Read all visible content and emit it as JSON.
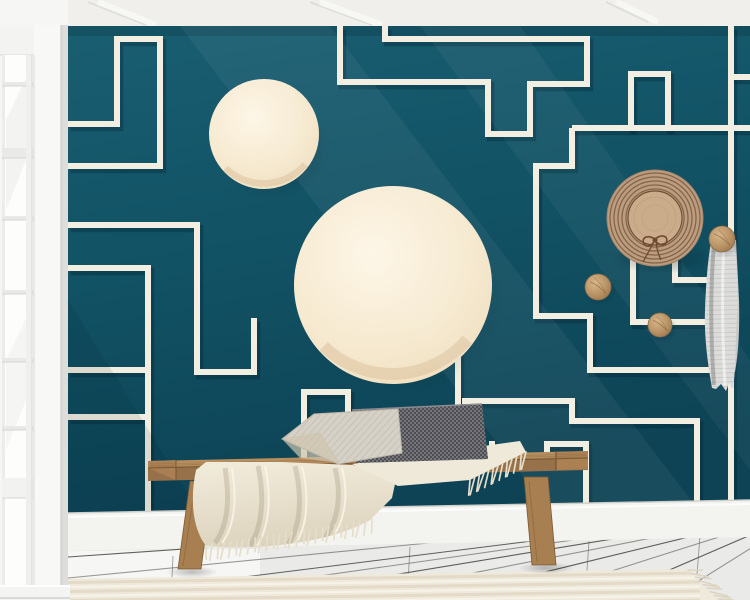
{
  "scene": {
    "name": "teal-geometric-maze-wallpaper-room-mockup",
    "width": 750,
    "height": 600
  },
  "palette": {
    "wall_teal_top": "#1a5e72",
    "wall_teal": "#115264",
    "wall_teal_bottom": "#0d4355",
    "line_cream": "#f2eee1",
    "line_shadow": "rgba(0,30,42,0.30)",
    "circle_cream_light": "#fdf6e7",
    "circle_cream_dark": "#eedcba",
    "ceiling_white": "#f0efec",
    "baseboard_white": "#f3f3f0",
    "floor_white": "#eaeae8",
    "floor_seam": "#3a3a36",
    "rug_base": "#efe9dc",
    "rug_stripe": "#e3dbc8",
    "wood_seat": "#b78f5f",
    "wood_front": "#97714a",
    "wood_leg": "#a87f50",
    "hat_brim": "#bc9d7f",
    "hat_ring": "#7d5a3e",
    "hat_crown": "#caab8a",
    "hat_bow": "#6e4b30",
    "knob_wood": "#b08a5c",
    "towel_gray": "#dcdcda",
    "pillow_light": "#d5d1c7",
    "pillow_dark": "#57575b",
    "blanket_cream": "#f0ead9"
  },
  "ceiling": {
    "height": 26,
    "color": "#f0efec",
    "beam_lines": [
      [
        88,
        2,
        146,
        25
      ],
      [
        310,
        2,
        372,
        25
      ],
      [
        606,
        2,
        648,
        22
      ]
    ],
    "beam_color": "#dcdcd7"
  },
  "wall": {
    "poly": [
      [
        68,
        26
      ],
      [
        750,
        26
      ],
      [
        750,
        500
      ],
      [
        68,
        513
      ]
    ],
    "line_width": 6,
    "maze_paths": [
      "M68,124 H117 V39 H160 V166 H68",
      "M68,225 H197 V372 H254 V318",
      "M68,268 H148 V511",
      "M68,370 H148",
      "M68,417 H148",
      "M340,26 V82 H488 V134 H530 V84 H587 V39 H385 V26",
      "M572,128 H750",
      "M572,128 V166 H536 V316 H590 V370 H728",
      "M631,131 V74 H668 V131",
      "M633,256 H675",
      "M633,252 V322 H731",
      "M675,252 V280 H731",
      "M731,23 V503",
      "M728,77 H750",
      "M304,458 V392 H348 V458",
      "M458,352 V462",
      "M462,401 H572 V421 H697 V505",
      "M547,461 V444 H586 V505",
      "M470,457 H492 V441"
    ],
    "circles": [
      {
        "cx": 264,
        "cy": 134,
        "r": 55
      },
      {
        "cx": 393,
        "cy": 285,
        "r": 99
      }
    ]
  },
  "window": {
    "frame_x": [
      34,
      60
    ],
    "glass_x": [
      2,
      34
    ],
    "glass_y": [
      55,
      586
    ],
    "muntin_ys": [
      82,
      148,
      216,
      290,
      358,
      426
    ],
    "thick_muntin": 148,
    "sash_rail_y": 478,
    "vertical_muntin_x": 26,
    "sill_y": 586
  },
  "baseboard": {
    "poly": [
      [
        68,
        513
      ],
      [
        750,
        500
      ],
      [
        750,
        537
      ],
      [
        68,
        552
      ]
    ],
    "color": "#f3f3f0"
  },
  "floor": {
    "poly": [
      [
        0,
        552
      ],
      [
        750,
        537
      ],
      [
        750,
        600
      ],
      [
        0,
        600
      ]
    ],
    "vanishing_point": [
      820,
      505
    ],
    "seam_starts": [
      [
        68,
        557
      ],
      [
        68,
        578
      ],
      [
        68,
        599
      ],
      [
        150,
        600
      ],
      [
        240,
        600
      ],
      [
        335,
        600
      ],
      [
        430,
        600
      ],
      [
        520,
        600
      ],
      [
        600,
        600
      ],
      [
        668,
        600
      ]
    ],
    "ticks": [
      [
        173,
        556,
        171,
        600
      ],
      [
        410,
        547,
        407,
        600
      ],
      [
        589,
        541,
        585,
        599
      ],
      [
        700,
        536,
        697,
        575
      ]
    ]
  },
  "rug": {
    "poly": [
      [
        38,
        600
      ],
      [
        54,
        579
      ],
      [
        688,
        569
      ],
      [
        718,
        600
      ]
    ],
    "stripe_offsets": [
      4,
      8.5,
      13,
      17.5,
      22,
      26.5,
      31
    ]
  },
  "bench": {
    "seat_top": [
      [
        148,
        461
      ],
      [
        588,
        451
      ],
      [
        588,
        458
      ],
      [
        148,
        468
      ]
    ],
    "seat_front": [
      [
        148,
        468
      ],
      [
        588,
        458
      ],
      [
        588,
        470
      ],
      [
        148,
        481
      ]
    ],
    "cap_right": [
      [
        556,
        452
      ],
      [
        588,
        451
      ],
      [
        588,
        469
      ],
      [
        556,
        470
      ]
    ],
    "cap_left": [
      [
        148,
        461
      ],
      [
        176,
        460
      ],
      [
        176,
        480
      ],
      [
        148,
        468
      ]
    ],
    "leg_left": [
      [
        190,
        481
      ],
      [
        213,
        481
      ],
      [
        201,
        569
      ],
      [
        178,
        569
      ]
    ],
    "leg_right": [
      [
        524,
        477
      ],
      [
        548,
        477
      ],
      [
        556,
        565
      ],
      [
        532,
        565
      ]
    ]
  },
  "pillows": {
    "dark": [
      [
        352,
        410
      ],
      [
        482,
        404
      ],
      [
        488,
        459
      ],
      [
        356,
        463
      ]
    ],
    "light": [
      [
        282,
        439
      ],
      [
        314,
        414
      ],
      [
        398,
        409
      ],
      [
        402,
        453
      ],
      [
        338,
        464
      ]
    ]
  },
  "blanket": {
    "main_path": "M196,470 L206,462 L282,462 L352,465 L398,470 L392,498 L370,520 C330,543 258,551 206,546 C192,528 190,498 196,470 Z",
    "seat_right_path": "M352,464 L520,441 L526,452 L470,480 L398,486 Z",
    "fold_paths": [
      "M225,468 C230,500 228,525 215,543",
      "M258,466 C265,498 262,527 250,546",
      "M295,466 C303,498 300,528 288,544",
      "M335,468 C342,495 338,520 325,538"
    ]
  },
  "decor": {
    "hat": {
      "cx": 655,
      "cy": 218,
      "brim_r": 48,
      "ring_radii": [
        29,
        33,
        37,
        41,
        45
      ],
      "crown_r": 27
    },
    "knobs": [
      {
        "cx": 598,
        "cy": 287,
        "r": 13
      },
      {
        "cx": 660,
        "cy": 325,
        "r": 12
      },
      {
        "cx": 722,
        "cy": 239,
        "r": 13
      }
    ],
    "towel": {
      "back_path": "M711,240 L736,240 L739,300 C740,340 737,360 735,372 L709,370 C706,330 707,270 711,240 Z",
      "front_path": "M714,231 L731,231 L734,243 C737,262 739,290 737,318 C735,345 736,368 733,389 L729,383 L726,391 L721,384 L716,389 L712,388 C708,365 704,338 705,310 C706,282 708,258 711,243 Z",
      "stripe_y": [
        234,
        388,
        4.5
      ]
    }
  },
  "fringes": [
    {
      "x1": 54,
      "y1": 580,
      "x2": 38,
      "y2": 599,
      "n": 7,
      "len": 15,
      "ang": 185,
      "color": "#ddd4bf",
      "w": 1.6
    },
    {
      "x1": 688,
      "y1": 570,
      "x2": 718,
      "y2": 599,
      "n": 9,
      "len": 16,
      "ang": 8,
      "color": "#ddd4bf",
      "w": 1.6
    },
    {
      "x1": 206,
      "y1": 546,
      "x2": 372,
      "y2": 519,
      "n": 28,
      "len": 15,
      "ang": 96,
      "color": "#e6decb",
      "w": 1.7
    },
    {
      "x1": 470,
      "y1": 480,
      "x2": 526,
      "y2": 452,
      "n": 13,
      "len": 17,
      "ang": 102,
      "color": "#e6decb",
      "w": 1.7
    }
  ]
}
